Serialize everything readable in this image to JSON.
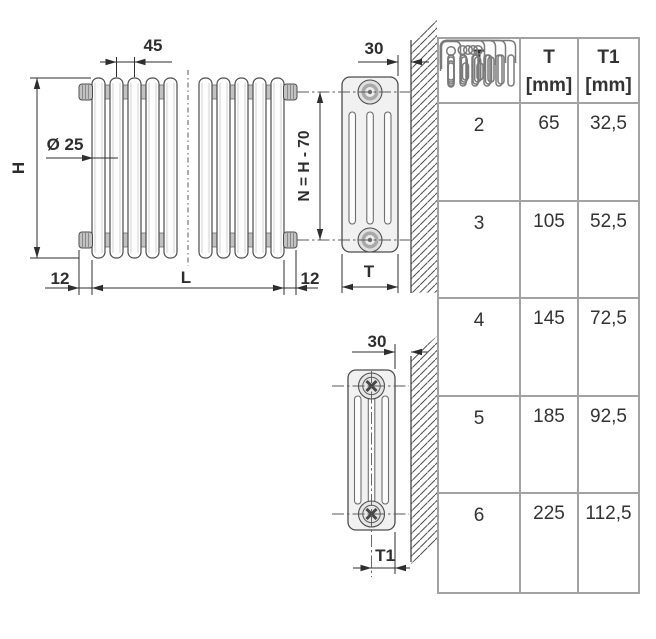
{
  "drawing": {
    "front": {
      "dim_pitch": "45",
      "dim_height": "H",
      "dim_diameter": "Ø 25",
      "dim_offset_left": "12",
      "dim_length": "L",
      "dim_offset_right": "12",
      "dim_axis": "N = H - 70"
    },
    "side_top": {
      "dim_wall": "30",
      "dim_depth": "T"
    },
    "side_bottom": {
      "dim_wall": "30",
      "dim_half_depth": "T1"
    }
  },
  "table": {
    "headers": {
      "col_type": "T",
      "col_t_line1": "T",
      "col_t_line2": "[mm]",
      "col_t1_line1": "T1",
      "col_t1_line2": "[mm]"
    },
    "rows": [
      {
        "columns": "2",
        "label": "2",
        "t": "65",
        "t1": "32,5"
      },
      {
        "columns": "3",
        "label": "3",
        "t": "105",
        "t1": "52,5"
      },
      {
        "columns": "4",
        "label": "4",
        "t": "145",
        "t1": "72,5"
      },
      {
        "columns": "5",
        "label": "5",
        "t": "185",
        "t1": "92,5"
      },
      {
        "columns": "6",
        "label": "6",
        "t": "225",
        "t1": "112,5"
      }
    ]
  },
  "colors": {
    "line": "#3d3d3d",
    "dim": "#2e2e2e",
    "hatch": "#4f4f4f",
    "table_border": "#a3a3a3",
    "body_fill": "#f1f1f1",
    "connector_fill": "#c2c2c2"
  }
}
